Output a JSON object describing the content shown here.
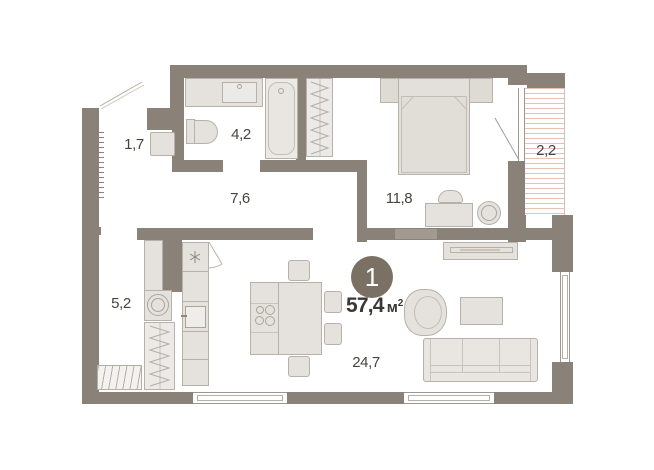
{
  "plan": {
    "unit_badge": {
      "number": "1"
    },
    "total_area": {
      "value": "57,4",
      "unit": "м",
      "unit_sup": "2"
    },
    "rooms": [
      {
        "name": "entry-niche",
        "area": "1,7"
      },
      {
        "name": "bathroom",
        "area": "4,2"
      },
      {
        "name": "hallway",
        "area": "7,6"
      },
      {
        "name": "bedroom",
        "area": "11,8"
      },
      {
        "name": "balcony",
        "area": "2,2"
      },
      {
        "name": "storage",
        "area": "5,2"
      },
      {
        "name": "living-kitchen",
        "area": "24,7"
      }
    ],
    "colors": {
      "wall": "#8a8178",
      "furniture": "#e5e2dd",
      "badge_bg": "#7a7164",
      "balcony_stripe": "#e7bfb7",
      "label_text": "#474440"
    }
  }
}
